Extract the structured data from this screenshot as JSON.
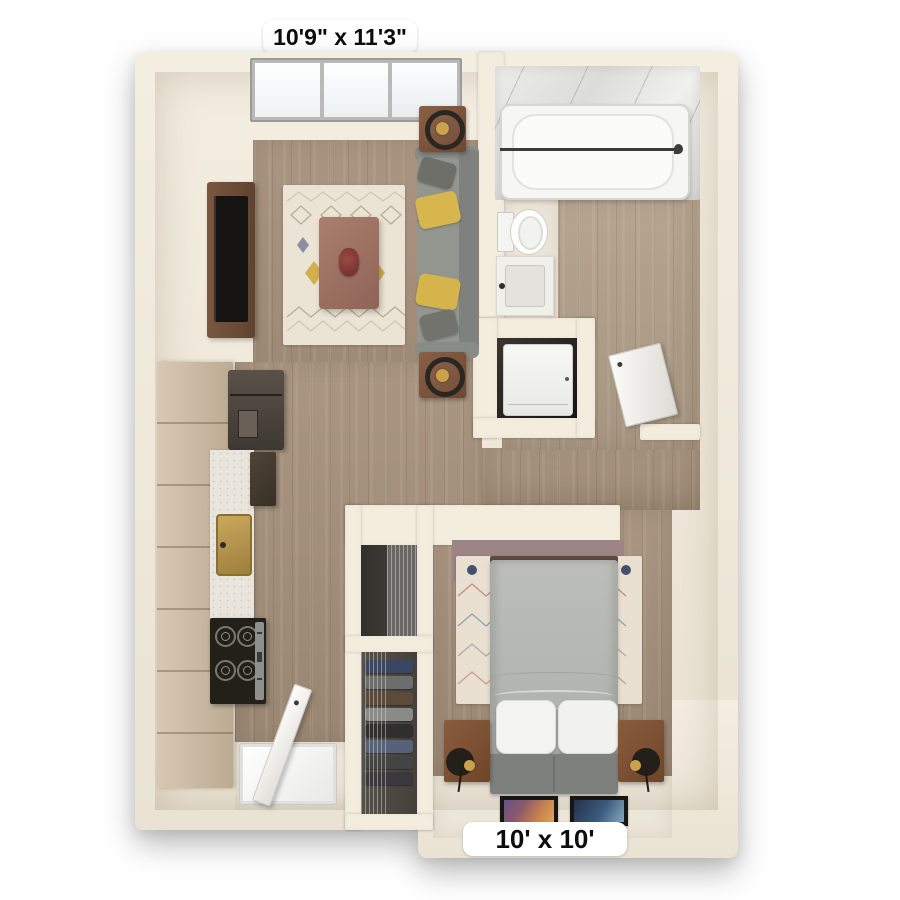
{
  "labels": {
    "living_room_dimensions": "10'9\" x 11'3\"",
    "bedroom_dimensions": "10' x 10'"
  },
  "colors": {
    "background": "#ffffff",
    "wall": "#f3edde",
    "wood_floor": "#a5907b",
    "bathroom_floor": "#b2a08b",
    "entry_floor": "#ece6d8",
    "sofa": "#8b8e8a",
    "accent_pillow_yellow": "#d6b44c",
    "coffee_table": "#a07568",
    "tv_console": "#6e4f3a",
    "living_rug": "#ebe4d4",
    "bed_duvet": "#b7b9b6",
    "bed_bench": "#7d807c",
    "nightstand": "#7a4e33",
    "bedroom_accent_wall": "#9c8487",
    "bedroom_rug": "#e9e0d2",
    "kitchen_cabinets": "#cdbca6",
    "refrigerator": "#473f38",
    "sink_brass": "#b2924c",
    "stove": "#232019",
    "marble": "#e9e7e4",
    "fixture_white": "#f6f6f4"
  },
  "rooms": {
    "living_room": {
      "furniture": [
        "window",
        "tv-console",
        "television",
        "area-rug",
        "coffee-table",
        "centerpiece",
        "sofa",
        "throw-pillows",
        "side-tables",
        "ring-lamps"
      ]
    },
    "kitchen": {
      "furniture": [
        "cabinets",
        "refrigerator",
        "countertop",
        "brass-sink",
        "upper-cabinet",
        "stove",
        "entry-door",
        "entry-mat"
      ]
    },
    "bathroom": {
      "furniture": [
        "marble-surround",
        "bathtub",
        "shower-rod",
        "toilet",
        "vanity-sink",
        "washer-dryer",
        "bathroom-door"
      ]
    },
    "closet": {
      "furniture": [
        "wire-shelving",
        "folded-clothes"
      ]
    },
    "bedroom": {
      "furniture": [
        "accent-wall",
        "area-rug",
        "wall-bed",
        "pillows",
        "bench",
        "nightstands",
        "sconce-lamps",
        "picture-frames"
      ]
    }
  }
}
